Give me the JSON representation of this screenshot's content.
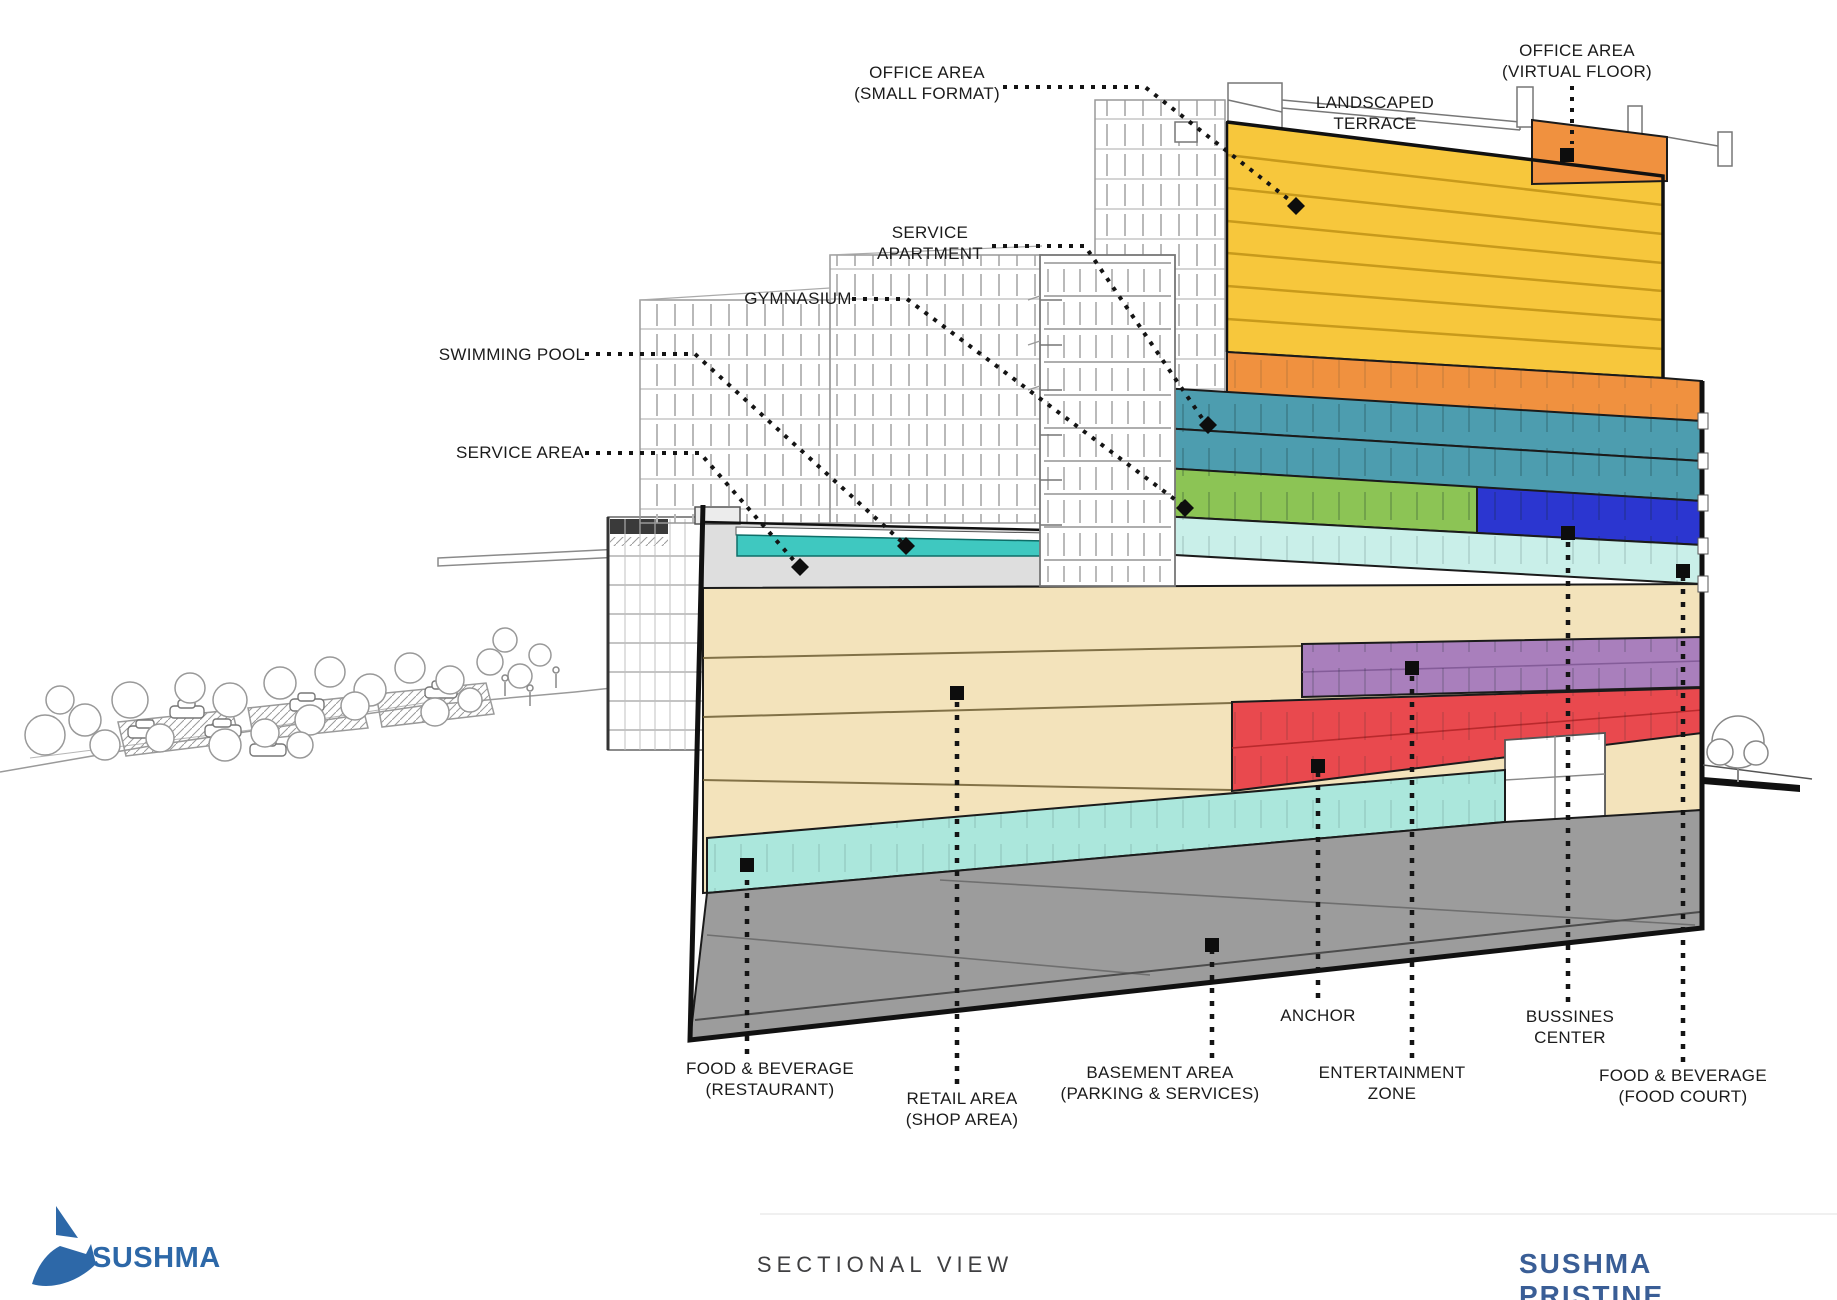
{
  "page": {
    "title": "SECTIONAL VIEW"
  },
  "footer": {
    "brand": "SUSHMA",
    "center_title": "SECTIONAL VIEW",
    "project": "SUSHMA PRISTINE"
  },
  "colors": {
    "office_yellow": "#F7C73C",
    "office_yellow_line": "#C89A1B",
    "terrace_orange": "#F0913F",
    "service_apartment_teal": "#4D9DAF",
    "gymnasium_green": "#8CC455",
    "bussines_blue": "#2B36D0",
    "foodcourt_cyan": "#C9EFE9",
    "restaurant_cyan": "#ABE7DC",
    "retail_beige": "#F3E3BB",
    "entertainment_purple": "#A97FBC",
    "anchor_red": "#E9494E",
    "basement_gray": "#9C9C9C",
    "slab_gray": "#DEDEDE",
    "pool_teal": "#3FC8C0",
    "brand_blue": "#2D68A8",
    "project_blue": "#3A5E96"
  },
  "labels": {
    "office_small_format": {
      "l1": "OFFICE AREA",
      "l2": "(SMALL FORMAT)"
    },
    "office_virtual_floor": {
      "l1": "OFFICE AREA",
      "l2": "(VIRTUAL FLOOR)"
    },
    "landscaped_terrace": {
      "l1": "LANDSCAPED",
      "l2": "TERRACE"
    },
    "service_apartment": {
      "l1": "SERVICE",
      "l2": "APARTMENT"
    },
    "gymnasium": {
      "l1": "GYMNASIUM"
    },
    "swimming_pool": {
      "l1": "SWIMMING POOL"
    },
    "service_area": {
      "l1": "SERVICE AREA"
    },
    "food_beverage_restaurant": {
      "l1": "FOOD & BEVERAGE",
      "l2": "(RESTAURANT)"
    },
    "retail_area": {
      "l1": "RETAIL AREA",
      "l2": "(SHOP AREA)"
    },
    "basement_area": {
      "l1": "BASEMENT AREA",
      "l2": "(PARKING & SERVICES)"
    },
    "anchor": {
      "l1": "ANCHOR"
    },
    "entertainment_zone": {
      "l1": "ENTERTAINMENT",
      "l2": "ZONE"
    },
    "bussines_center": {
      "l1": "BUSSINES",
      "l2": "CENTER"
    },
    "food_beverage_food_court": {
      "l1": "FOOD & BEVERAGE",
      "l2": "(FOOD COURT)"
    }
  }
}
